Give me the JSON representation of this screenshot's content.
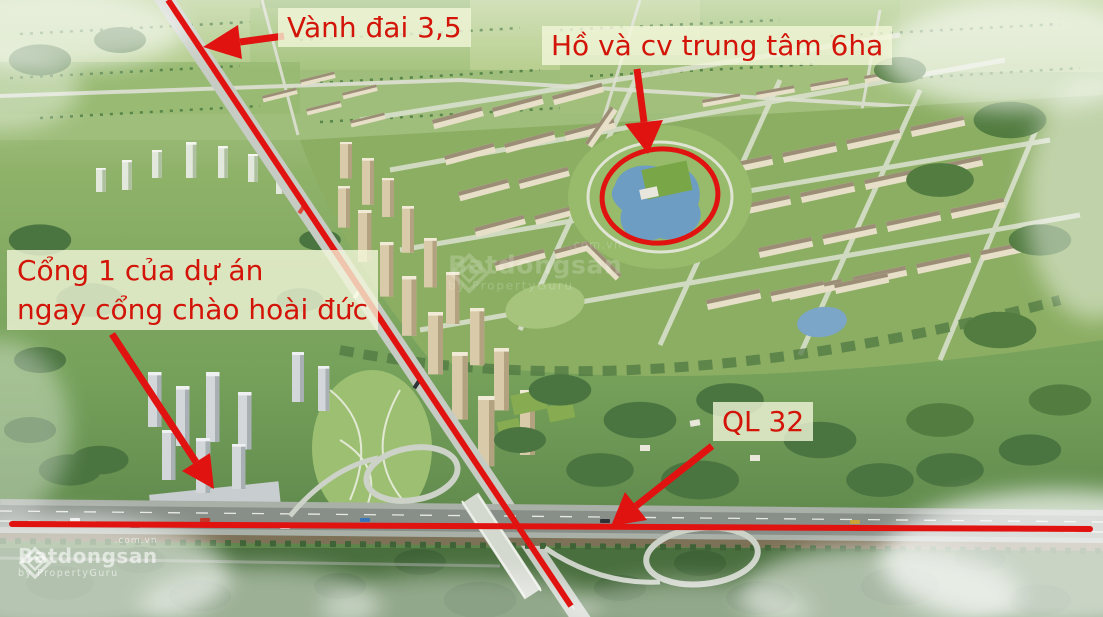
{
  "colors": {
    "accent": "#e11311",
    "label-bg": "rgba(243,247,219,0.78)",
    "label-text": "#d31408",
    "watermark": "rgba(255,255,255,0.58)"
  },
  "annotations": {
    "ring_road": {
      "text": "Vành đai 3,5"
    },
    "lake_park": {
      "text": "Hồ và cv trung tâm 6ha"
    },
    "gate1": {
      "line1": "Cổng 1 của dự án",
      "line2": "ngay cổng chào hoài đức"
    },
    "highway": {
      "text": "QL 32"
    }
  },
  "watermark": {
    "brand": "Batdongsan",
    "domain": ".com.vn",
    "byline": "by PropertyGuru"
  }
}
